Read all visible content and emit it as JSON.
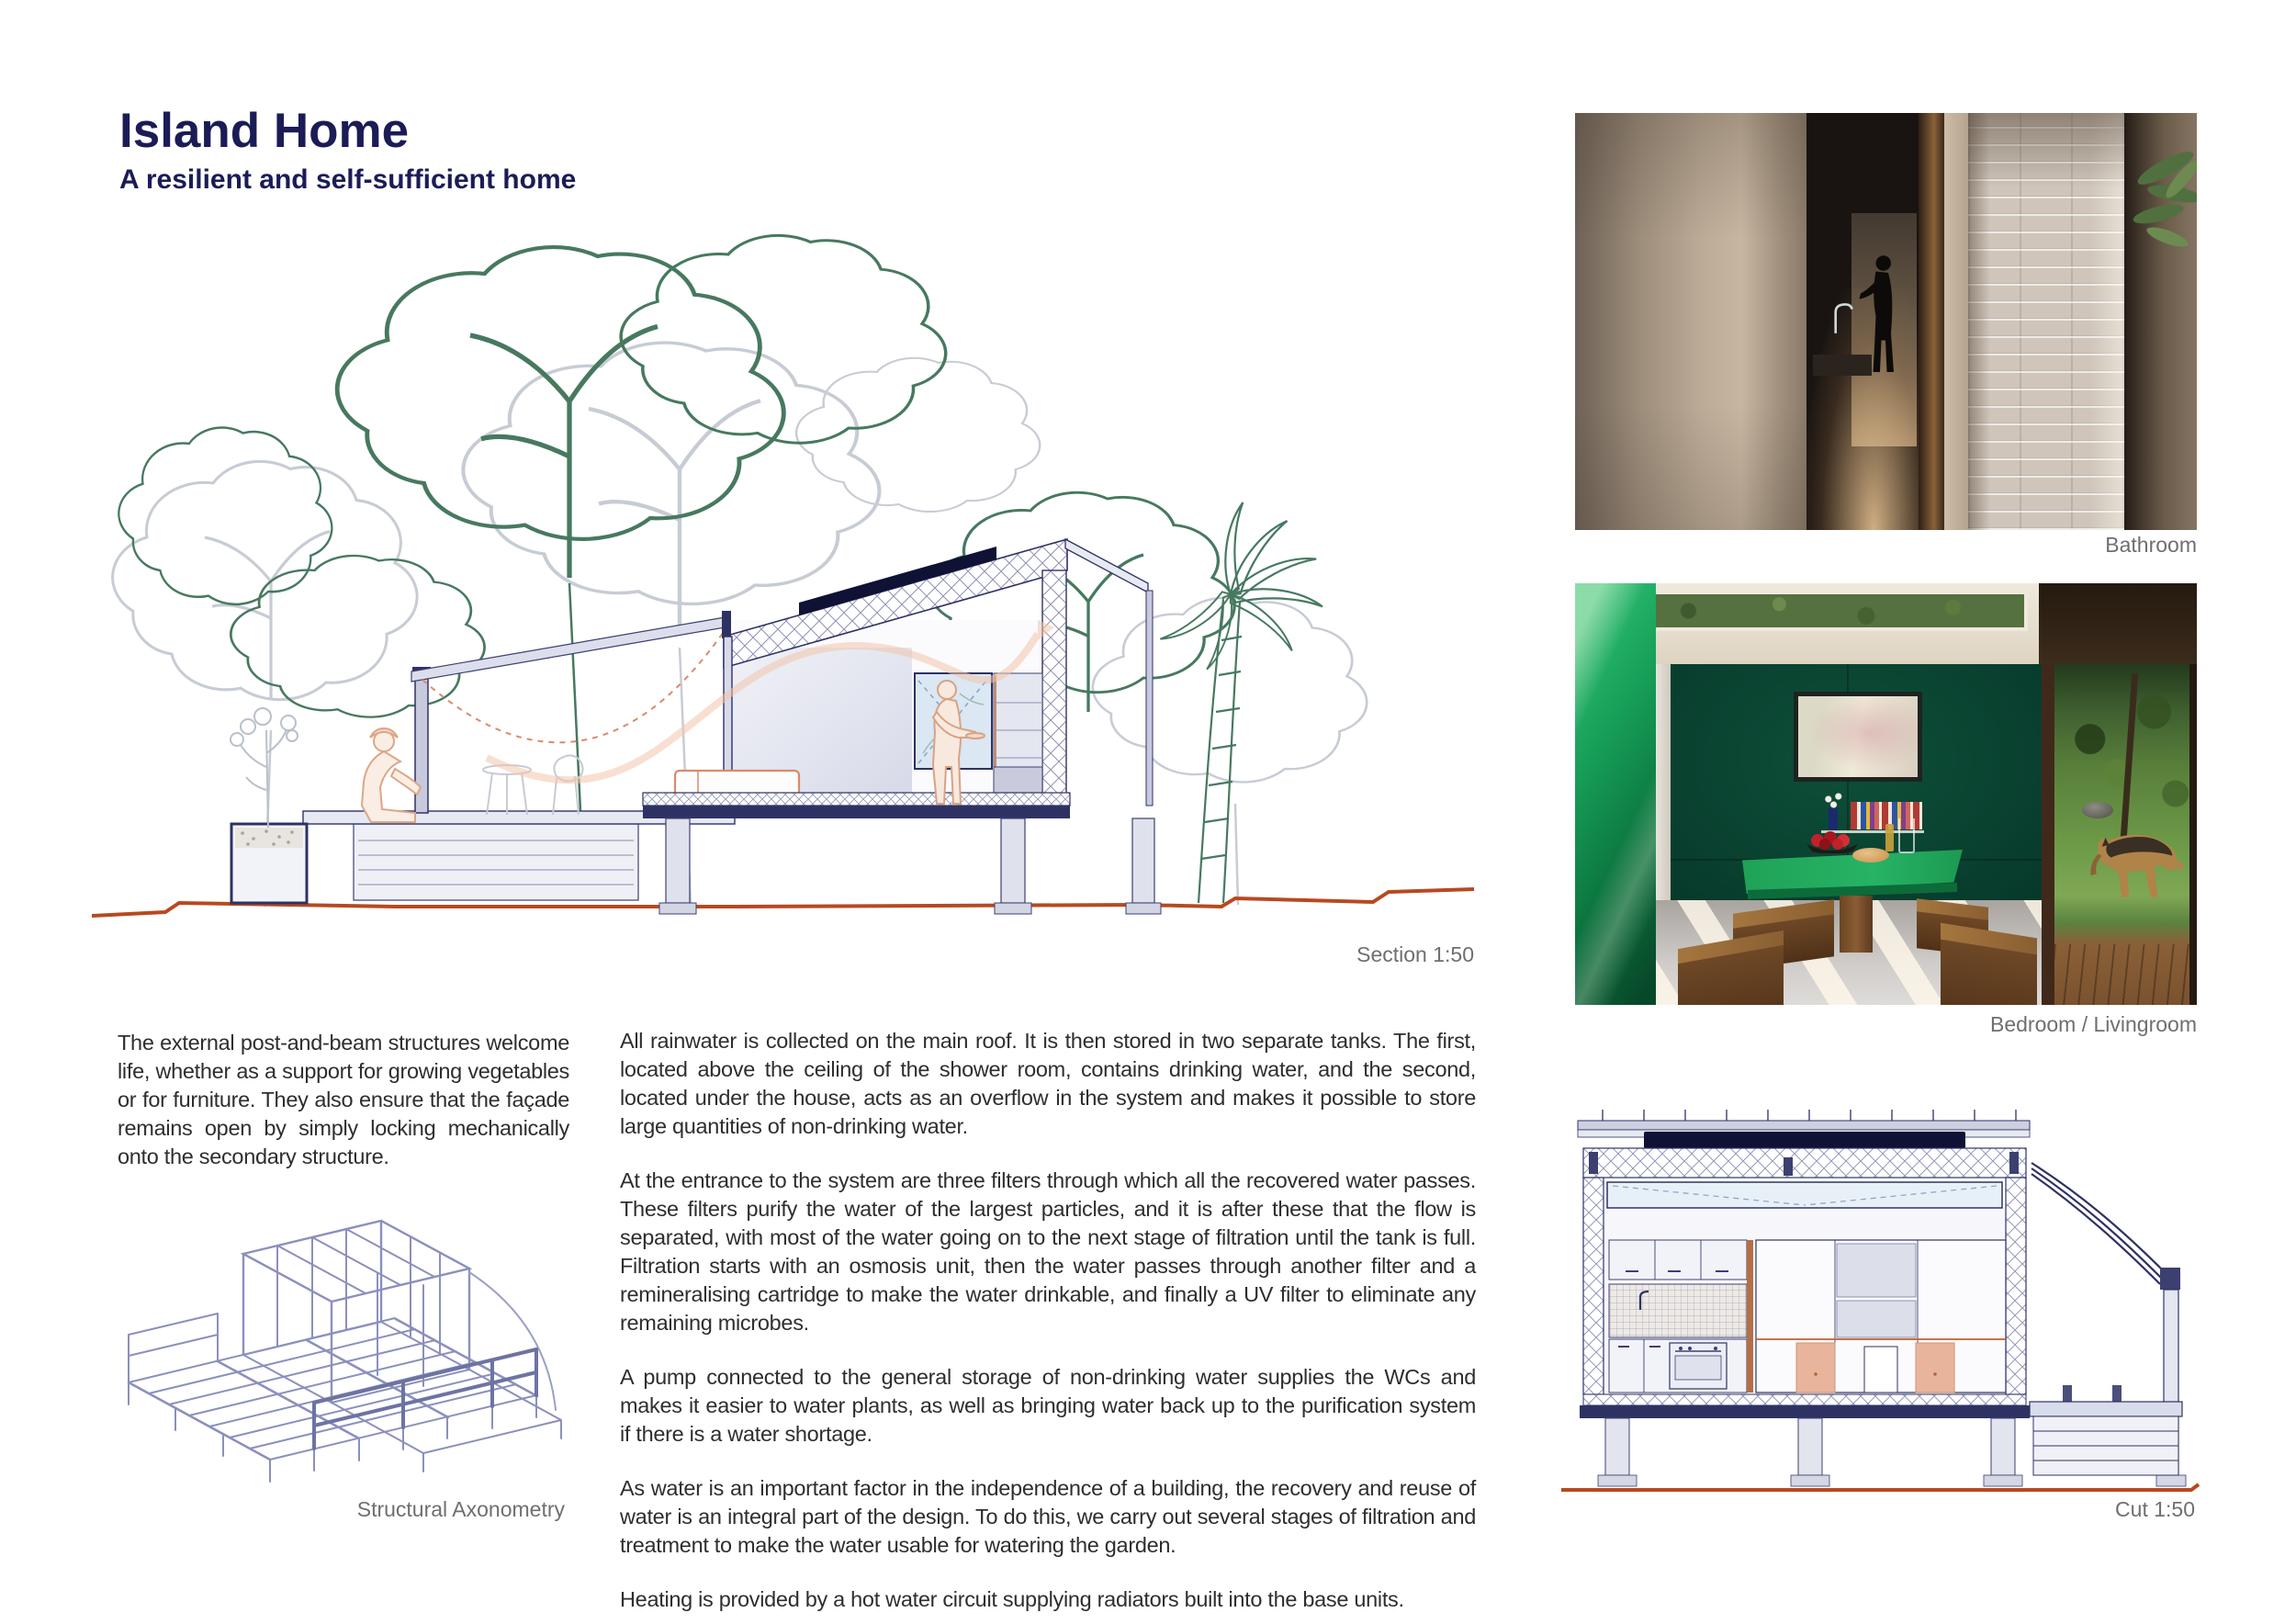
{
  "header": {
    "title": "Island Home",
    "subtitle": "A resilient and self-sufficient home"
  },
  "figures": {
    "section": {
      "caption": "Section 1:50"
    },
    "bathroom": {
      "caption": "Bathroom"
    },
    "bedroom": {
      "caption": "Bedroom / Livingroom"
    },
    "axonometry": {
      "caption": "Structural Axonometry"
    },
    "cut": {
      "caption": "Cut 1:50"
    }
  },
  "text": {
    "left_paragraph": "The external post-and-beam structures welcome life, whether as a support for growing vegetables or for furniture. They also ensure that the façade remains open by simply locking mechanically onto the secondary structure.",
    "paragraphs": [
      "All rainwater is collected on the main roof. It is then stored in two separate tanks. The first, located above the ceiling of the shower room, contains drinking water, and the second, located under the house, acts as an overflow in the system and makes it possible to store large quantities of non-drinking water.",
      "At the entrance to the system are three filters through which all the recovered water passes. These filters purify the water of the largest particles, and it is after these that the flow is separated, with most of the water going on to the next stage of filtration until the tank is full. Filtration starts with an osmosis unit, then the water passes through another filter and a remineralising cartridge to make the water drinkable, and finally a UV filter to eliminate any remaining microbes.",
      "A pump connected to the general storage of non-drinking water supplies the WCs and makes it easier to water plants, as well as bringing water back up to the purification system if there is a water shortage.",
      "As water is an important factor in the independence of a building, the recovery and reuse of water is an integral part of the design. To do this, we carry out several stages of filtration and treatment to make the water usable for watering the garden.",
      "Heating is provided by a hot water circuit supplying radiators built into the base units."
    ]
  },
  "colors": {
    "title_navy": "#1b1c56",
    "body_text": "#2e2e2e",
    "caption_gray": "#6f6f6f",
    "drawing_navy": "#2e3263",
    "drawing_lavender": "#d8dae8",
    "solar_panel": "#0f1135",
    "tree_green": "#47795f",
    "tree_gray": "#c7ccd4",
    "ground_rust": "#b8491f",
    "sketch_salmon": "#dca688",
    "bedroom_wall_green": "#0a4331",
    "bedroom_table_green": "#1fa257",
    "bathroom_beige": "#bcab97"
  }
}
